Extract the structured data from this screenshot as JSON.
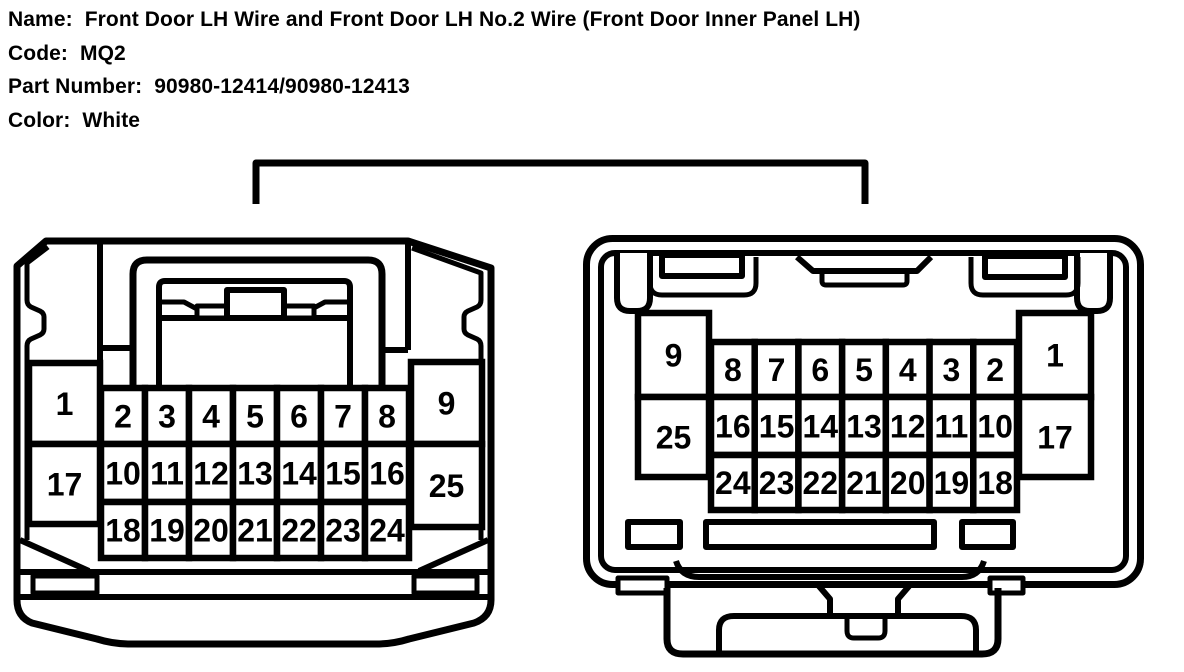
{
  "header": {
    "rows": [
      {
        "label": "Name:",
        "value": "Front Door LH Wire and Front Door LH No.2 Wire (Front Door Inner Panel LH)"
      },
      {
        "label": "Code:",
        "value": "MQ2"
      },
      {
        "label": "Part Number:",
        "value": "90980-12414/90980-12413"
      },
      {
        "label": "Color:",
        "value": "White"
      }
    ]
  },
  "diagram": {
    "background": "#ffffff",
    "line_color": "#000000",
    "connectors": [
      {
        "name": "front-door-lh-wire-connector",
        "left_column": [
          "1",
          "17"
        ],
        "grid_rows": [
          [
            "2",
            "3",
            "4",
            "5",
            "6",
            "7",
            "8"
          ],
          [
            "10",
            "11",
            "12",
            "13",
            "14",
            "15",
            "16"
          ],
          [
            "18",
            "19",
            "20",
            "21",
            "22",
            "23",
            "24"
          ]
        ],
        "right_column": [
          "9",
          "25"
        ]
      },
      {
        "name": "front-door-lh-no2-wire-connector",
        "left_column": [
          "9",
          "25"
        ],
        "grid_rows": [
          [
            "8",
            "7",
            "6",
            "5",
            "4",
            "3",
            "2"
          ],
          [
            "16",
            "15",
            "14",
            "13",
            "12",
            "11",
            "10"
          ],
          [
            "24",
            "23",
            "22",
            "21",
            "20",
            "19",
            "18"
          ]
        ],
        "right_column": [
          "1",
          "17"
        ]
      }
    ]
  }
}
